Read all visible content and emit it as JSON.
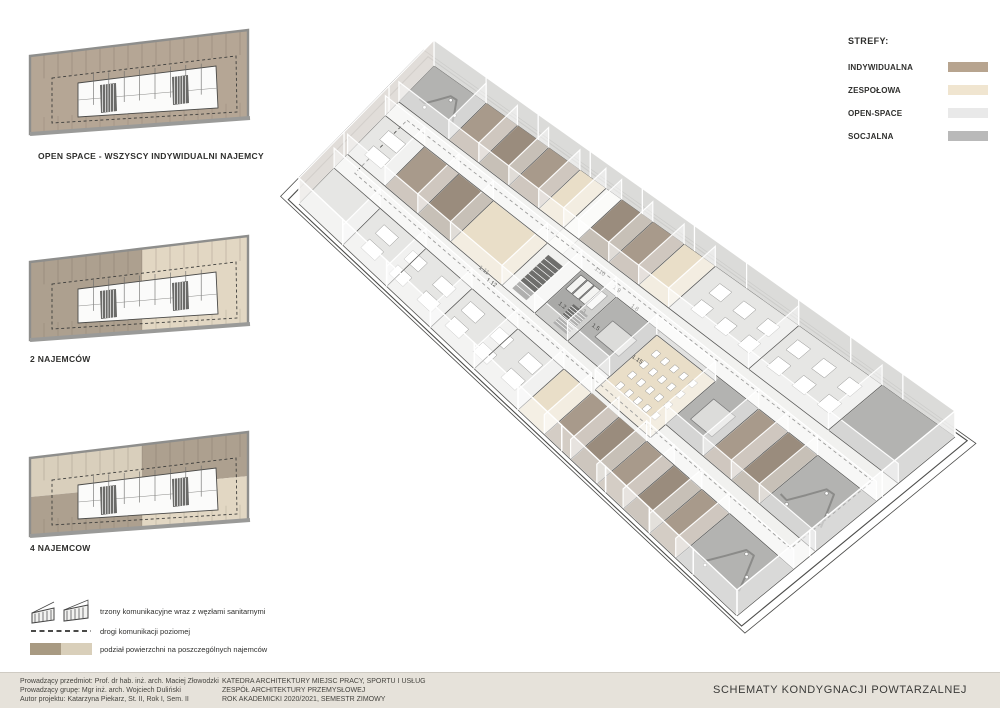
{
  "zones_legend": {
    "title": "STREFY:",
    "items": [
      {
        "label": "INDYWIDUALNA",
        "color": "#b7a48f"
      },
      {
        "label": "ZESPOŁOWA",
        "color": "#f0e5d0"
      },
      {
        "label": "OPEN-SPACE",
        "color": "#e9e9e9"
      },
      {
        "label": "SOCJALNA",
        "color": "#b9b9b9"
      }
    ]
  },
  "plans": [
    {
      "label": "OPEN SPACE - WSZYSCY INDYWIDUALNI NAJEMCY",
      "scheme": "single"
    },
    {
      "label": "2 NAJEMCÓW",
      "scheme": "halves"
    },
    {
      "label": "4 NAJEMCOW",
      "scheme": "quarters"
    }
  ],
  "symbols_legend": [
    {
      "icon": "stair-cores-icon",
      "label": "trzony komunikacyjne wraz z węzłami sanitarnymi"
    },
    {
      "icon": "dashed-line-icon",
      "label": "drogi komunikacji poziomej"
    },
    {
      "icon": "tenant-split-swatch",
      "label": "podział powierzchni na poszczególnych najemców"
    }
  ],
  "footer": {
    "credits": [
      "Prowadzący przedmiot: Prof. dr hab. inż. arch. Maciej Złowodzki",
      "Prowadzący grupę: Mgr inż. arch. Wojciech Duliński",
      "Autor projektu: Katarzyna Piekarz, St. II, Rok I, Sem. II"
    ],
    "department": [
      "KATEDRA ARCHITEKTURY MIEJSC PRACY, SPORTU I USŁUG",
      "ZESPÓŁ ARCHITEKTURY PRZEMYSŁOWEJ",
      "ROK AKADEMICKI 2020/2021, SEMESTR ZIMOWY"
    ],
    "title": "SCHEMATY KONDYGNACJI POWTARZALNEJ"
  },
  "axon": {
    "room_labels": [
      {
        "text": "1.2",
        "u": 0.415,
        "v": 0.545
      },
      {
        "text": "1.3",
        "u": 0.442,
        "v": 0.505
      },
      {
        "text": "1.5",
        "u": 0.478,
        "v": 0.525
      },
      {
        "text": "1.8",
        "u": 0.497,
        "v": 0.355
      },
      {
        "text": "1.9",
        "u": 0.455,
        "v": 0.34
      },
      {
        "text": "1.10",
        "u": 0.413,
        "v": 0.325
      },
      {
        "text": "1.11",
        "u": 0.283,
        "v": 0.65
      },
      {
        "text": "1.12",
        "u": 0.306,
        "v": 0.672
      },
      {
        "text": "1.15",
        "u": 0.56,
        "v": 0.52
      }
    ],
    "colors": {
      "individual": "#a89a8b",
      "individual2": "#9a8c7d",
      "team": "#e9dec8",
      "openspace": "#e6e6e4",
      "social": "#b3b3b1",
      "corridor": "#f1f1ef",
      "core": "#a9a9a7",
      "dark": "#6e6e6c",
      "base": "#cbcbc9",
      "wall": "#ffffff"
    }
  },
  "plan_colors": {
    "individual": "#b5a695",
    "individual_dark": "#ada08f",
    "team_light": "#e2d7c3",
    "quarter_light": "#d9cfbc",
    "core_fill": "#fbfbfa",
    "stair_dark": "#6a6a68",
    "outline": "#8e8e8c"
  }
}
